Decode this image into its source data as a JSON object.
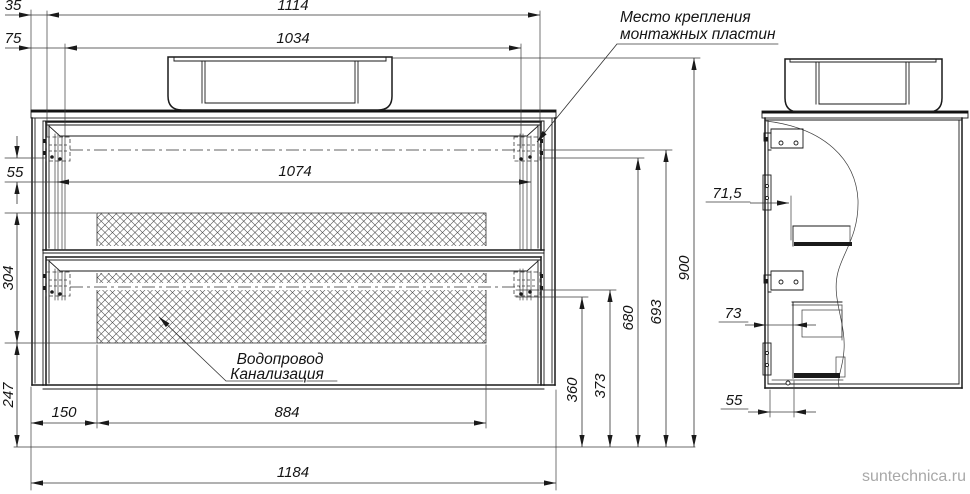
{
  "drawing": {
    "note_mounting": {
      "line1": "Место крепления",
      "line2": "монтажных пластин"
    },
    "note_utilities": {
      "line1": "Водопровод",
      "line2": "Канализация"
    },
    "front": {
      "d35": "35",
      "d75": "75",
      "d1114": "1114",
      "d1034": "1034",
      "d1074": "1074",
      "d55": "55",
      "d304": "304",
      "d247": "247",
      "d150": "150",
      "d884": "884",
      "d1184": "1184",
      "d360": "360",
      "d373": "373",
      "d680": "680",
      "d693": "693",
      "d900": "900"
    },
    "side": {
      "d71_5": "71,5",
      "d73": "73",
      "d55": "55"
    },
    "watermark": "suntechnica.ru",
    "colors": {
      "line": "#1a1a1a",
      "thin_line": "#3a3a3a",
      "hatch": "#4a4a4a",
      "watermark": "#a8a8a8",
      "background": "#ffffff"
    }
  }
}
